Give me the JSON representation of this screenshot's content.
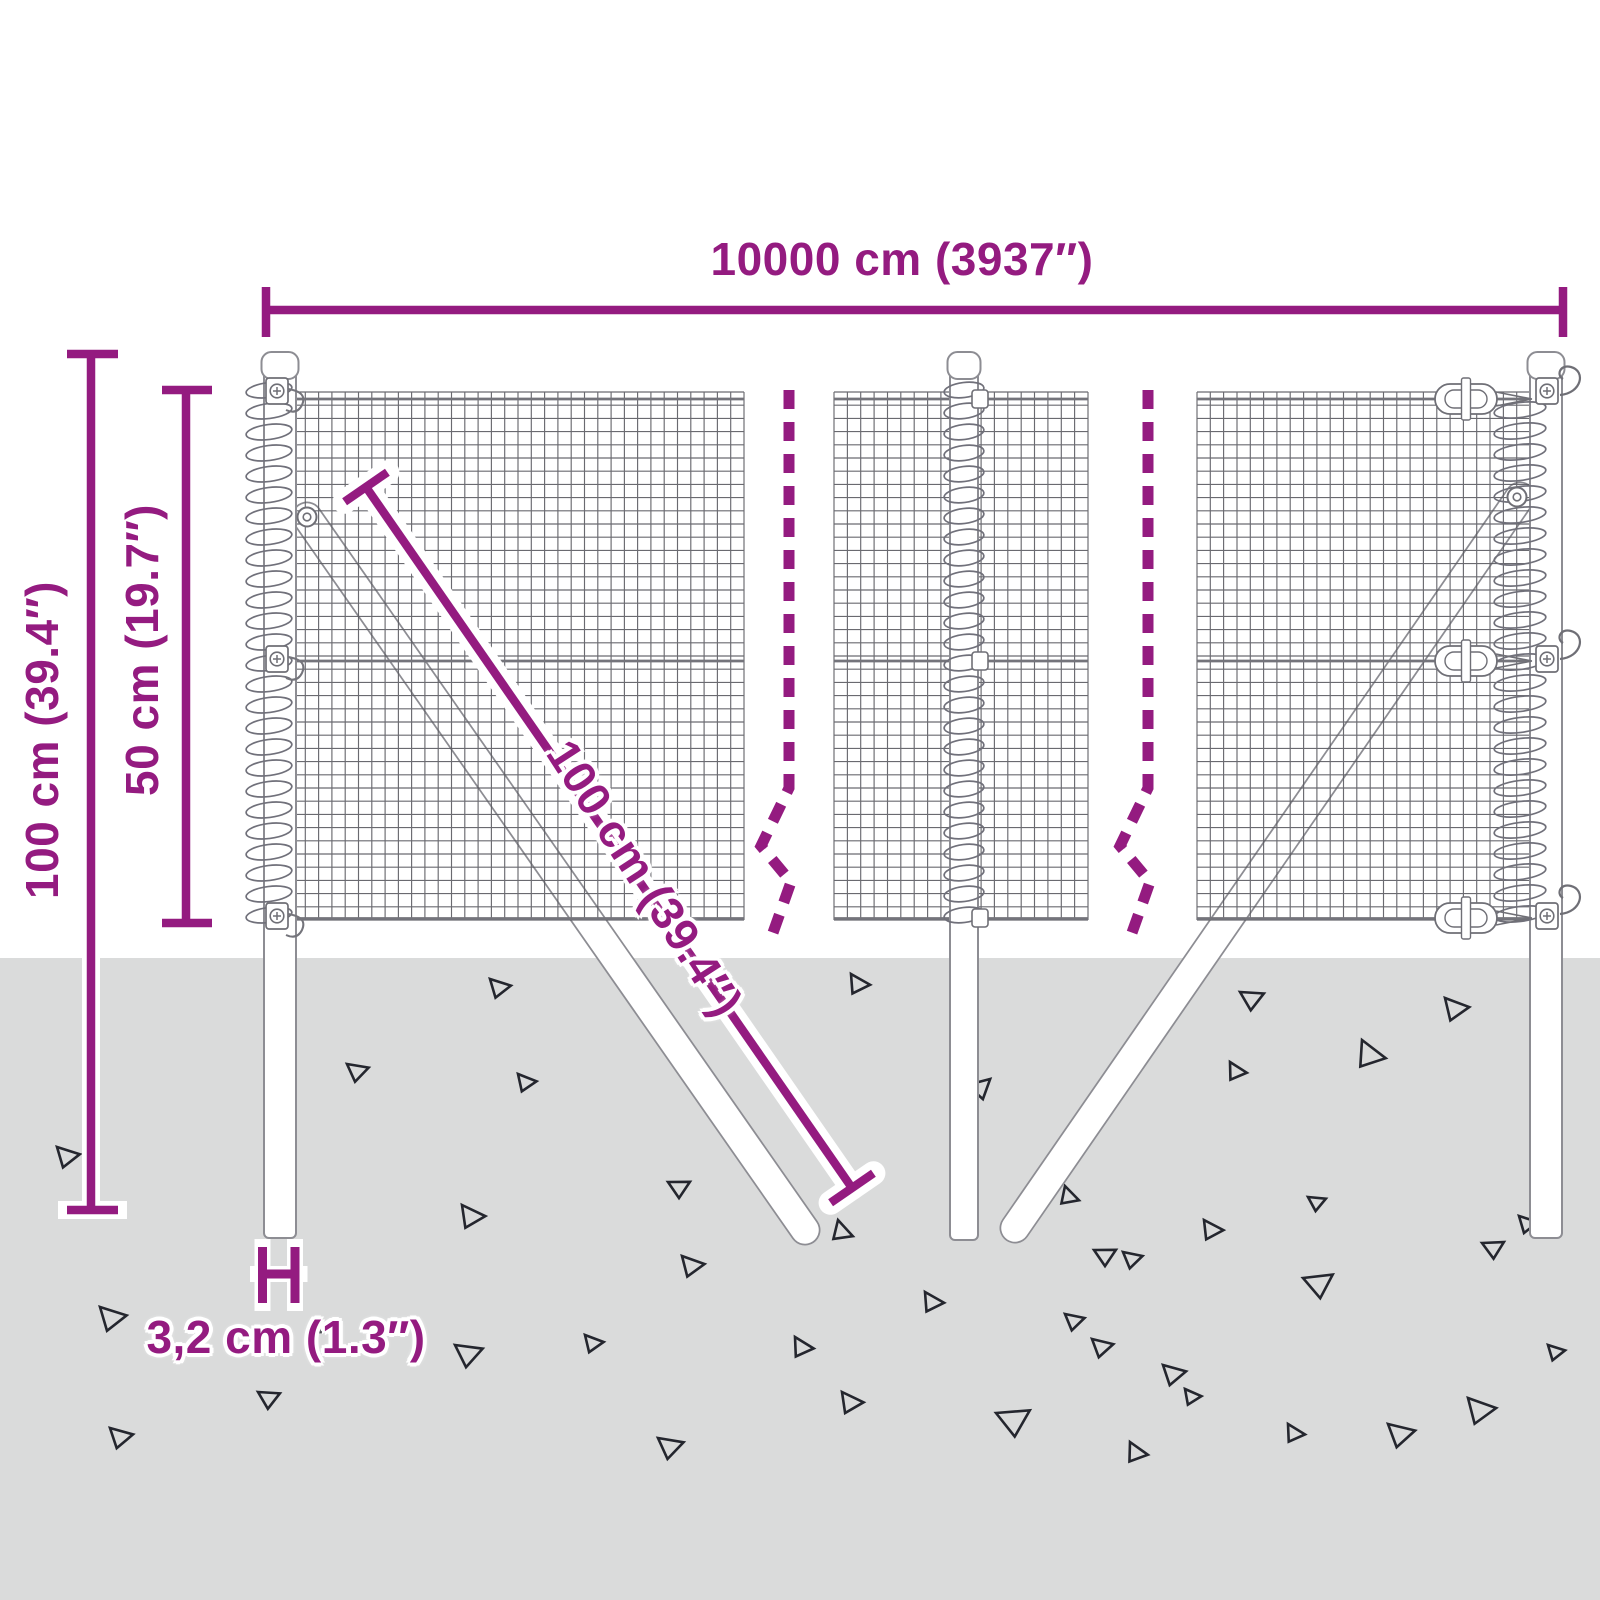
{
  "diagram": {
    "labels": {
      "width_total": "10000 cm (3937″)",
      "height_total": "100 cm (39.4″)",
      "height_mesh": "50 cm (19.7″)",
      "length_brace": "100 cm (39.4″)",
      "width_post": "3,2 cm (1.3″)"
    },
    "colors": {
      "accent": "#941b80",
      "ground": "#dadbdb",
      "outline": "#8d8d93",
      "mesh": "#5a5a61",
      "wire": "#74747b",
      "hardware": "#6f6f76",
      "triangle": "#24262e",
      "background": "#ffffff"
    }
  }
}
